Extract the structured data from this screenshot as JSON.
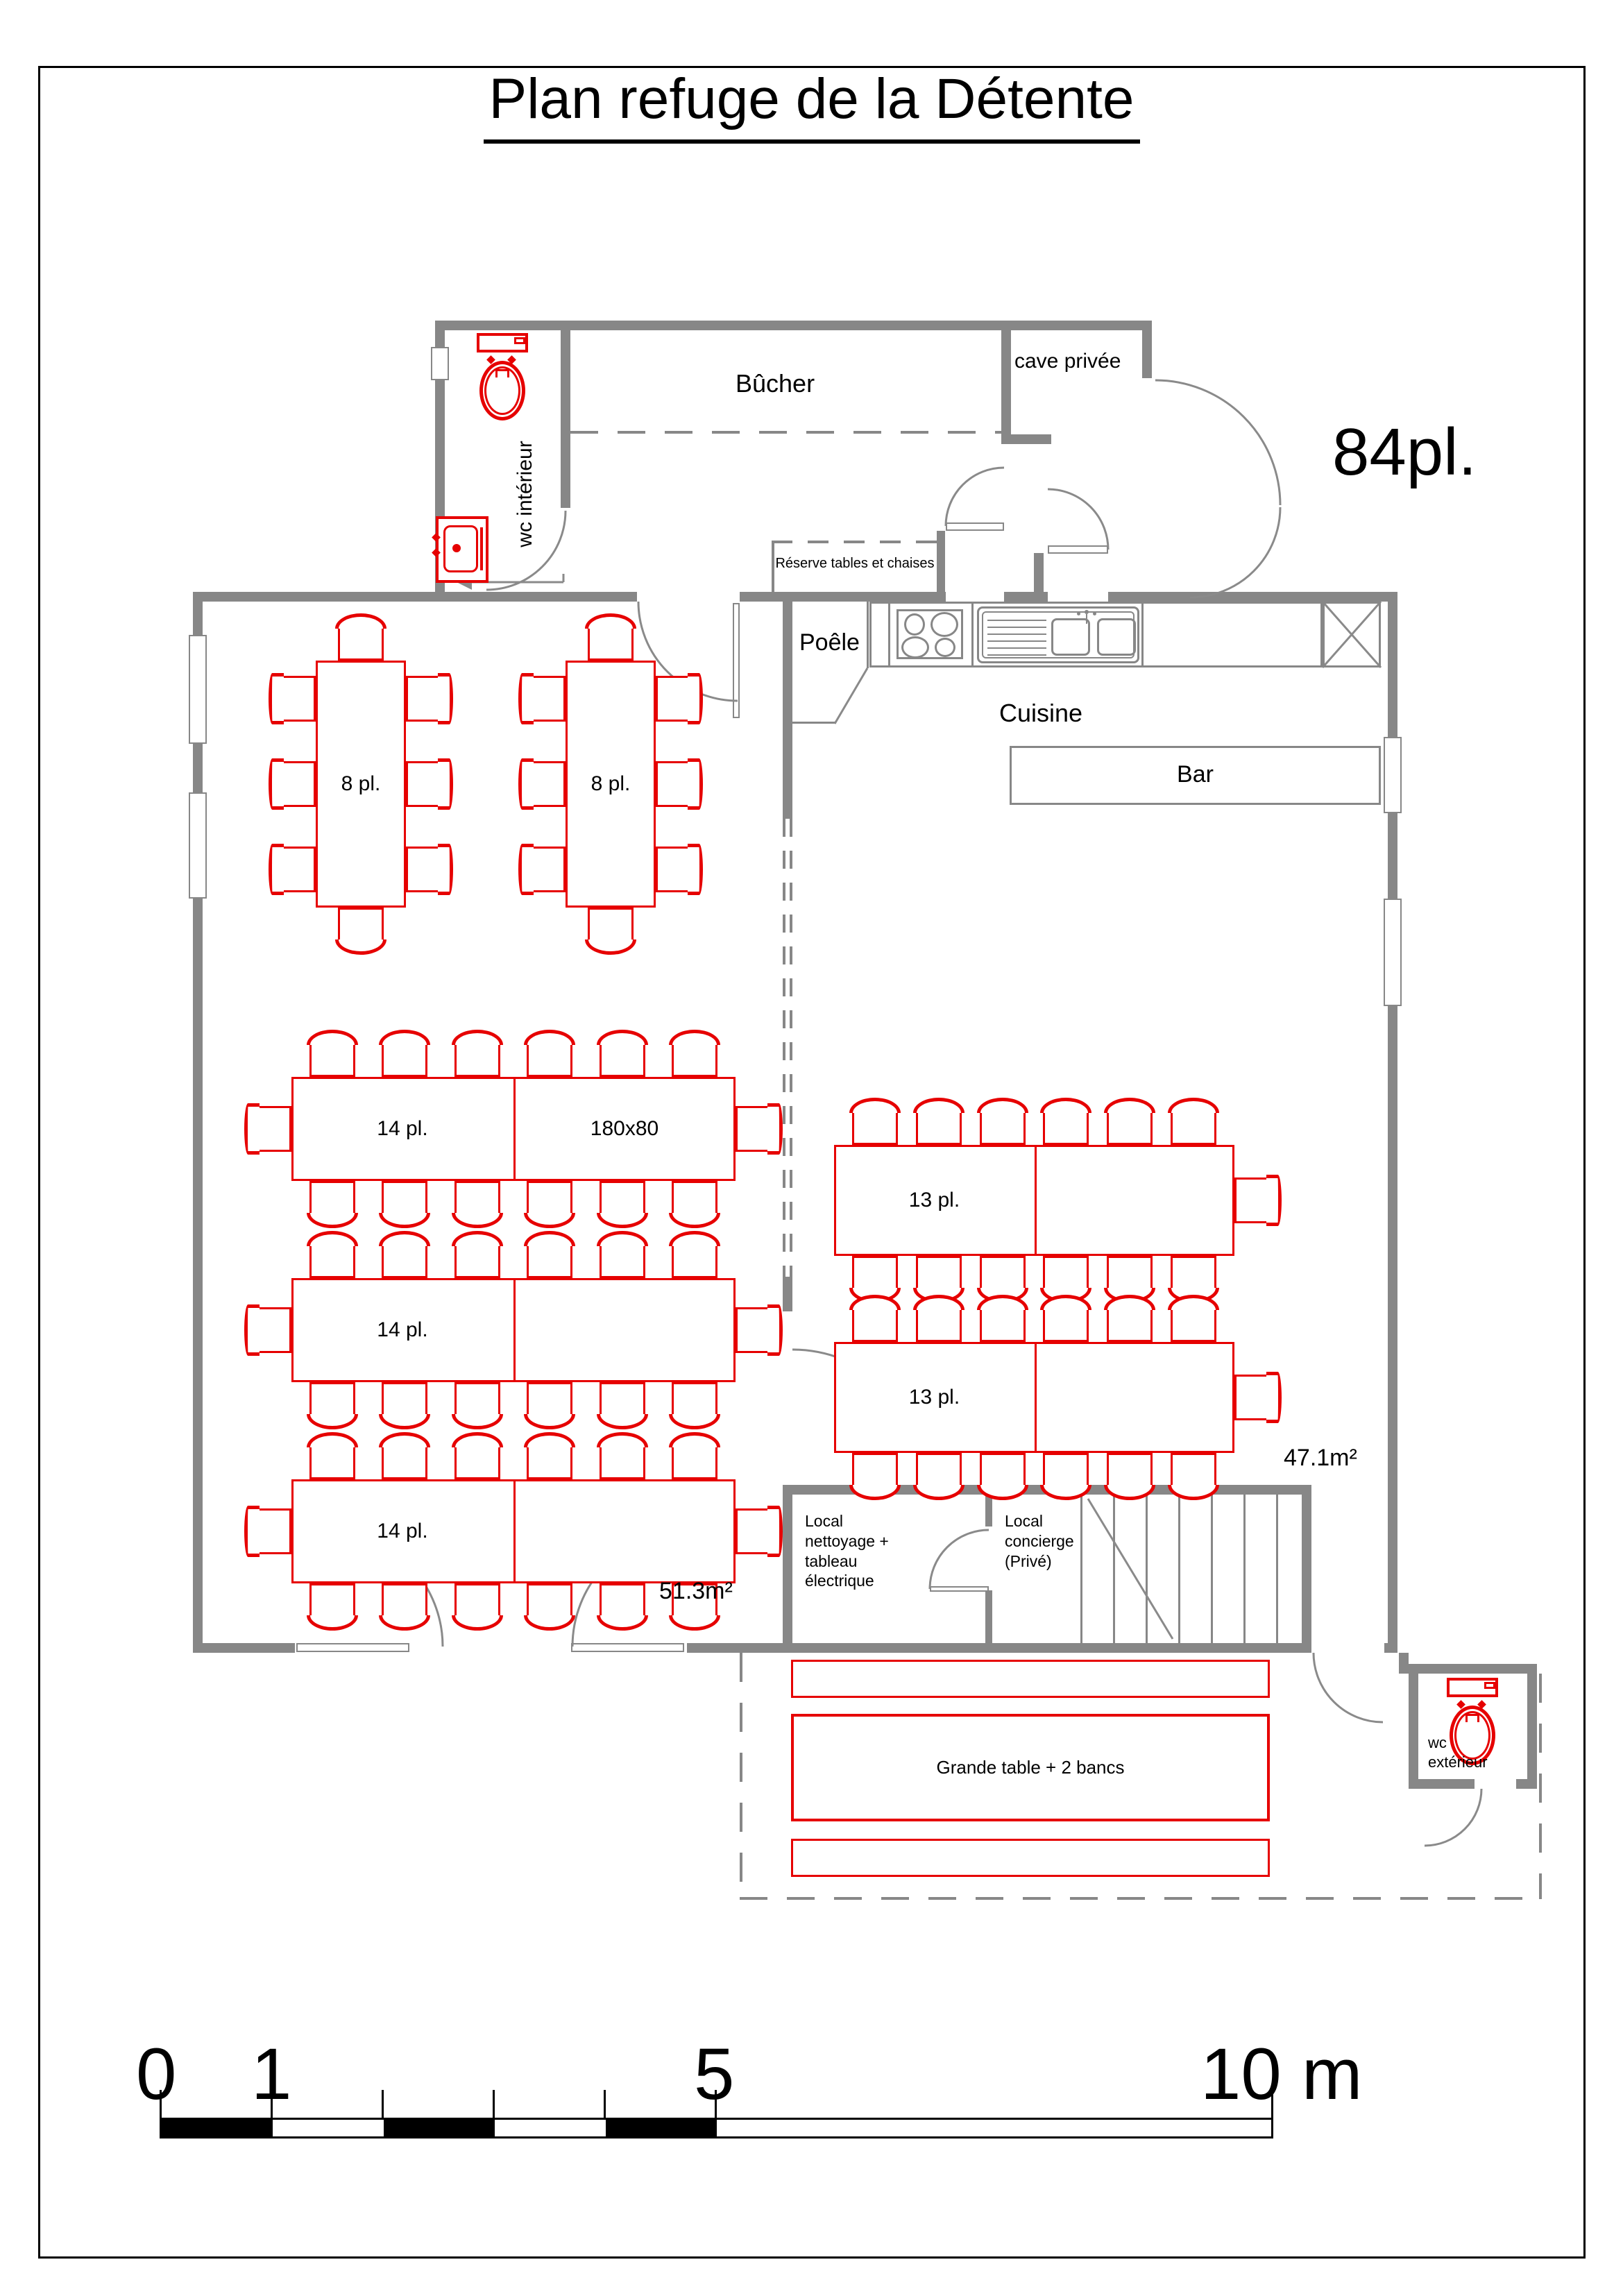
{
  "title": "Plan refuge de la Détente",
  "capacity": "84pl.",
  "rooms": {
    "bucher": "Bûcher",
    "cave_privee": "cave privée",
    "wc_interieur": "wc intérieur",
    "reserve": "Réserve tables et chaises",
    "poele": "Poêle",
    "cuisine": "Cuisine",
    "bar": "Bar",
    "local_nettoyage": "Local\nnettoyage +\ntableau\nélectrique",
    "local_concierge": "Local\nconcierge\n(Privé)",
    "wc_exterieur": "wc\nextérieur"
  },
  "areas": {
    "main_hall": "51.3m²",
    "kitchen_side": "47.1m²"
  },
  "furniture": {
    "table8_a": "8 pl.",
    "table8_b": "8 pl.",
    "table14_a": "14 pl.",
    "table14_a_size": "180x80",
    "table14_b": "14 pl.",
    "table14_c": "14 pl.",
    "table13_a": "13 pl.",
    "table13_b": "13 pl.",
    "grande_table": "Grande table + 2 bancs"
  },
  "scale_bar": {
    "labels": [
      "0",
      "1",
      "5",
      "10 m"
    ]
  },
  "icons": [
    "toilet-icon",
    "sink-icon",
    "stove-icon",
    "kitchen-sink-icon",
    "stairs-icon",
    "crossed-box-icon"
  ],
  "colors": {
    "wall": "#878787",
    "furniture": "#e60000",
    "text": "#000000"
  }
}
